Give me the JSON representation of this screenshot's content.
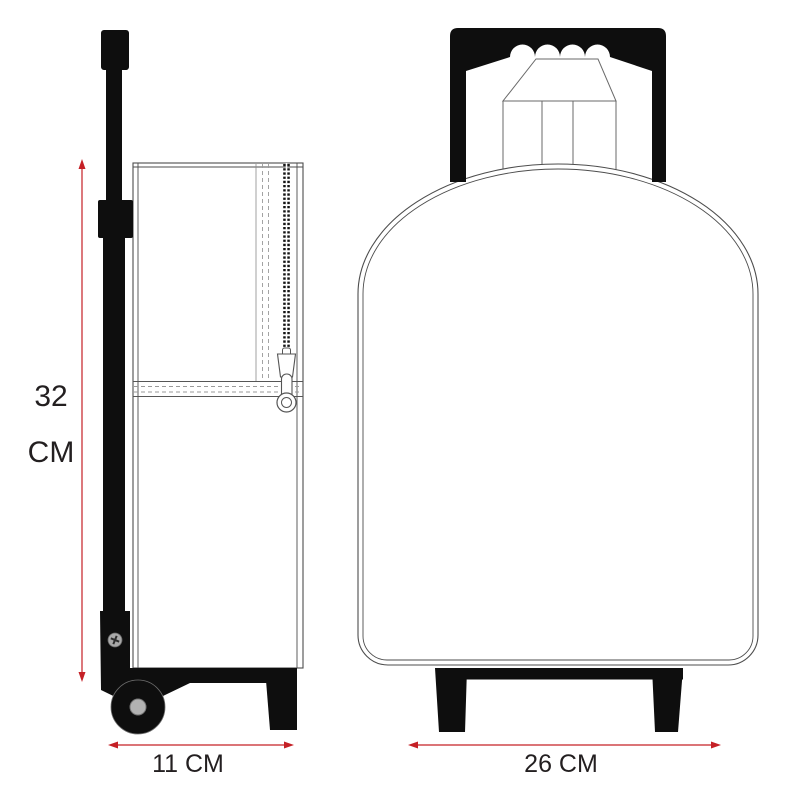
{
  "diagram": {
    "kind": "trolley-backpack-dimension-diagram",
    "dimensions": {
      "height": {
        "value": "32",
        "unit": "CM"
      },
      "depth": {
        "value": "11 CM"
      },
      "width": {
        "value": "26 CM"
      }
    },
    "colors": {
      "dimension_annotation": "#c52026",
      "ink": "#0e0e0e",
      "outline": "#4d4d4d"
    }
  }
}
